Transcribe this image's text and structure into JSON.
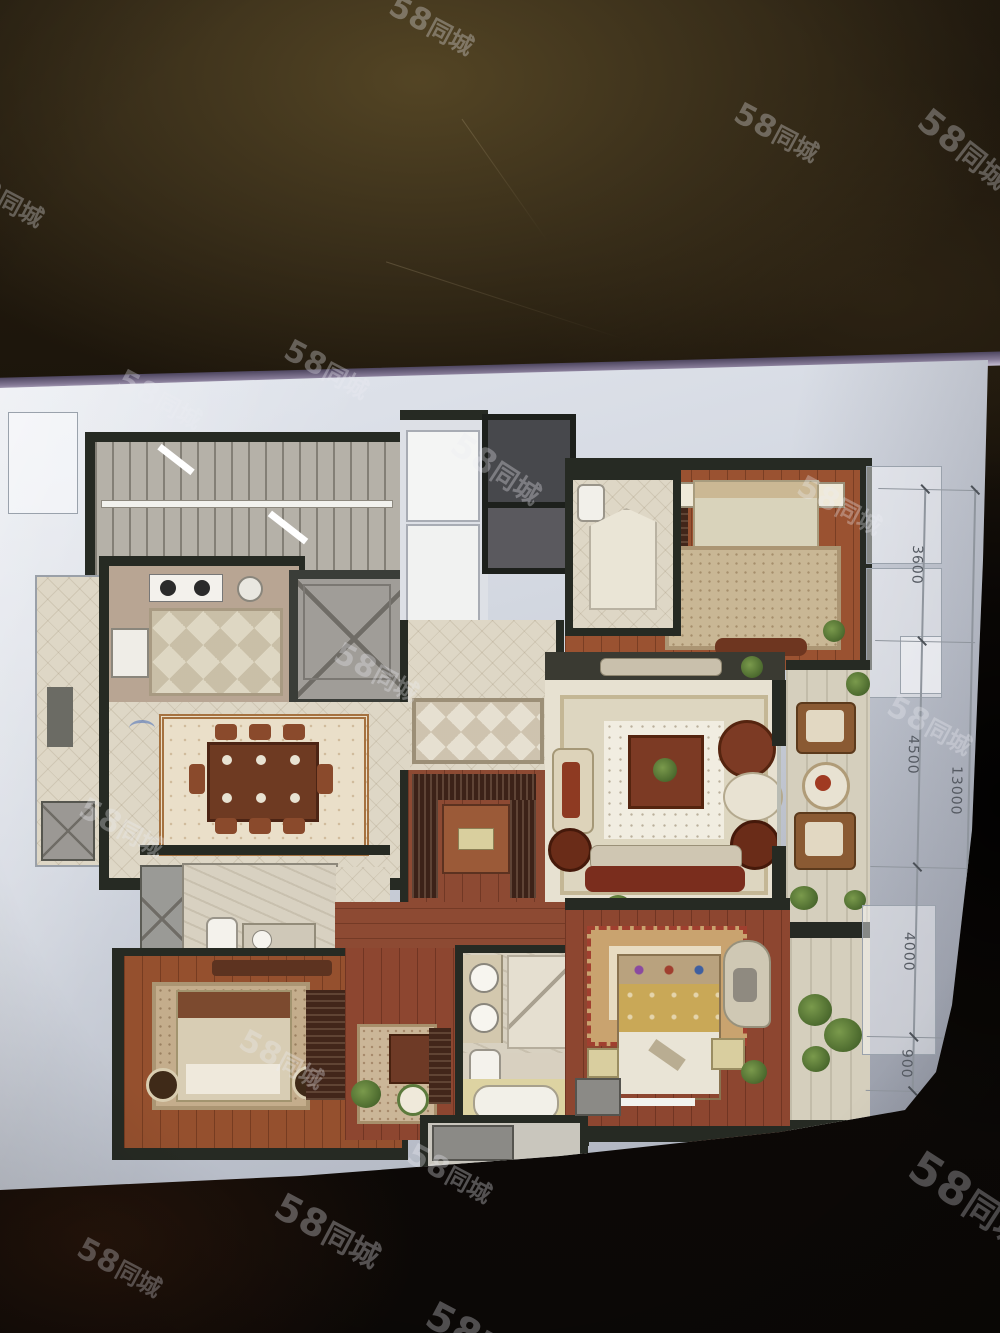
{
  "watermark": {
    "text_bold": "58",
    "text_rest": "同城",
    "full_text": "58同城"
  },
  "dimensions": {
    "side_labels": [
      "3600",
      "4500",
      "4000",
      "900"
    ],
    "total_label": "13000"
  },
  "colors": {
    "table_background": "#241c10",
    "sheet": "#dde1e9",
    "screen_edge_tint": "#857a96",
    "wall": "#262a23",
    "wood_floor": "#9a5231",
    "tile_floor": "#ded7c6",
    "watermark": "rgba(235,235,242,0.32)",
    "dimension_text": "#565b63"
  }
}
